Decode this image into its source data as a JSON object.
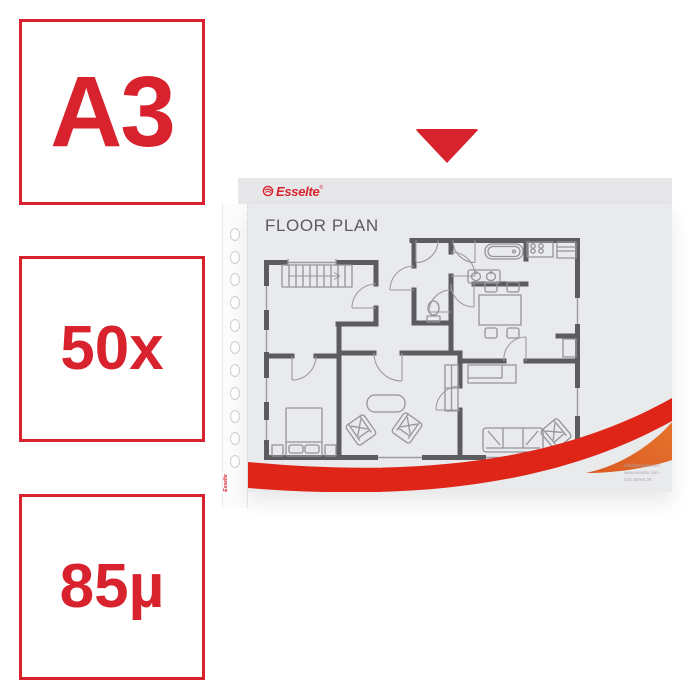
{
  "product_card": {
    "spec_badges": [
      {
        "label": "A3"
      },
      {
        "label": "50x"
      },
      {
        "label": "85µ"
      }
    ],
    "arrow_icon": "red-down-triangle",
    "pocket": {
      "brand_logo_text": "Esselte",
      "registered_mark": "®",
      "swirl_icon": "esselte-swirl",
      "punch_hole_count": 11,
      "edge_vertical_label": "Esselte",
      "document": {
        "title": "FLOOR PLAN",
        "type": "floor-plan-drawing",
        "contact_lines": [
          "info@esselte.com",
          "www.esselte.com",
          "City Street 29"
        ]
      }
    },
    "colors": {
      "brand_red": "#d8232e",
      "swoosh_red": "#df2418",
      "swoosh_orange": "#e0662a",
      "wall_gray": "#5c5c60",
      "pocket_gray": "#e9eaec",
      "flap_gray": "#e7e7e9"
    }
  }
}
